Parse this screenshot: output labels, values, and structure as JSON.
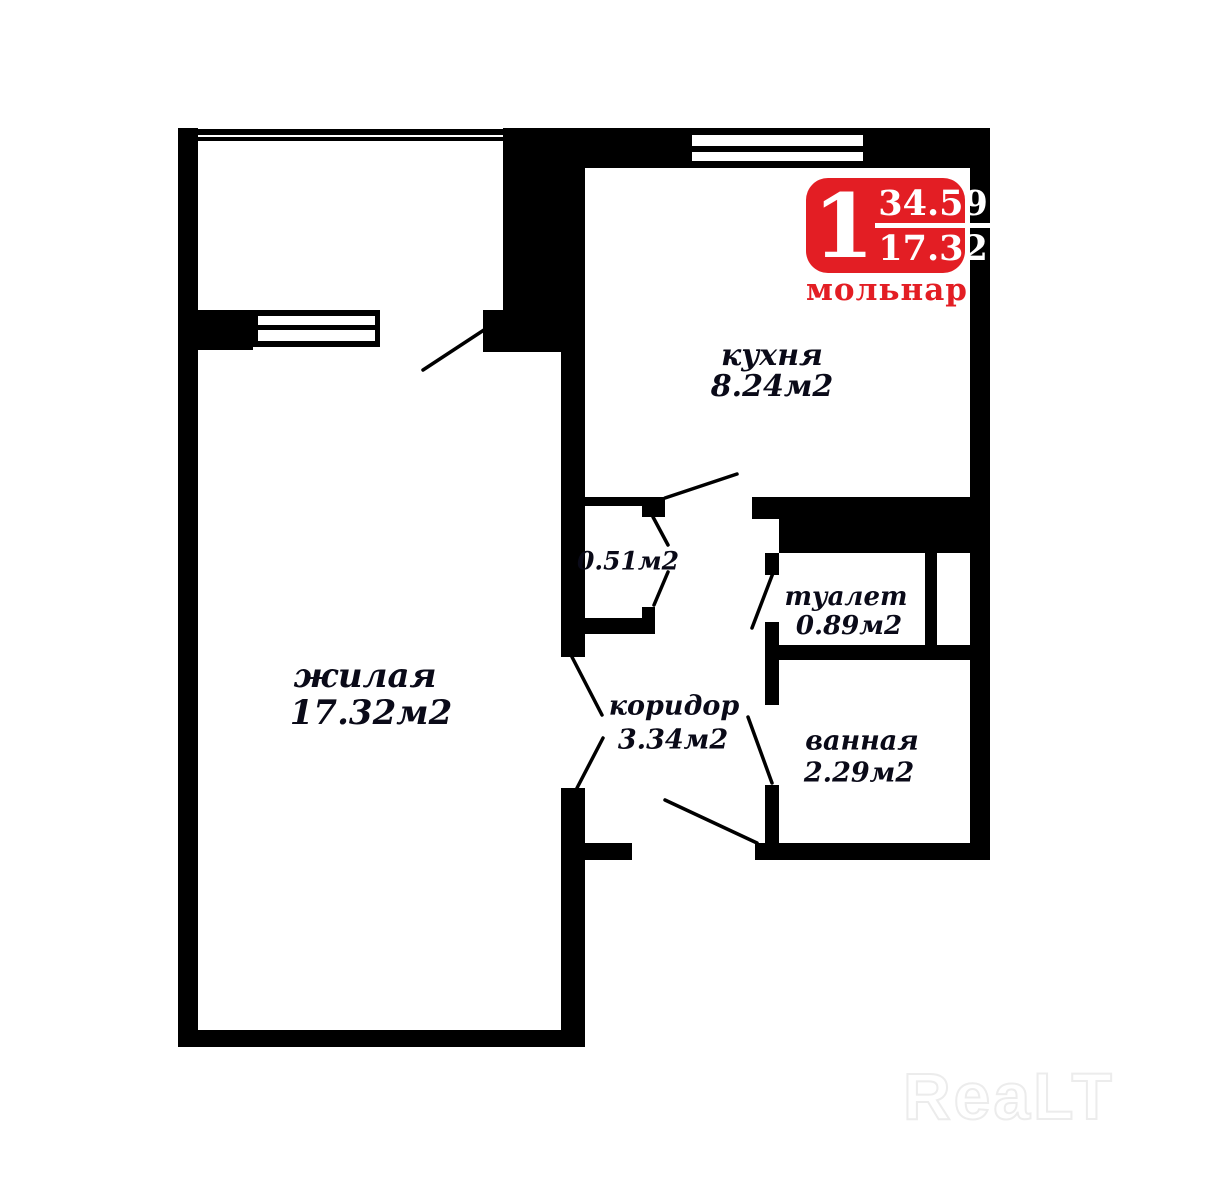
{
  "plan": {
    "rooms": [
      {
        "name": "жилая",
        "area": "17.32м2"
      },
      {
        "name": "кухня",
        "area": "8.24м2"
      },
      {
        "name": "коридор",
        "area": "3.34м2"
      },
      {
        "name": "туалет",
        "area": "0.89м2"
      },
      {
        "name": "ванная",
        "area": "2.29м2"
      },
      {
        "name": "",
        "area": "0.51м2"
      }
    ]
  },
  "badge": {
    "rooms": "1",
    "total_area": "34.59",
    "living_area": "17.32",
    "brand": "мольнар",
    "color": "#e31e24"
  },
  "watermark": {
    "text": "ReaLT",
    "color": "#ececec"
  },
  "colors": {
    "wall": "#000000",
    "background": "#ffffff"
  }
}
